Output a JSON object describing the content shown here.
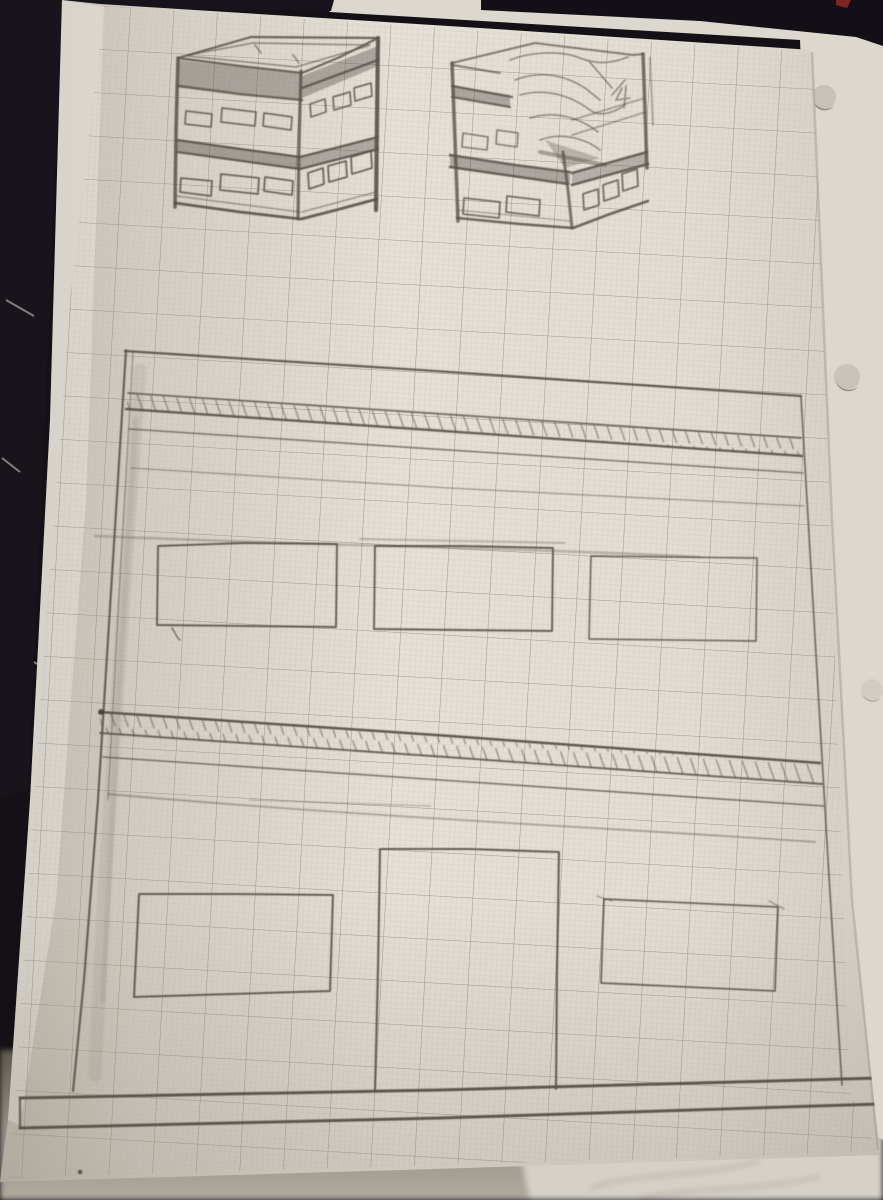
{
  "meta": {
    "title": "Photograph of pencil sketches on graph paper",
    "subject": "hand-drawn architectural pencil sketches on millimetre graph paper, photographed on a dark fabric surface"
  },
  "colors": {
    "background_fabric": "#17151b",
    "desk": "#8d877d",
    "paper_bright": "#e4e0d8",
    "paper_shadow": "#bfb9ae",
    "paper_margin": "#edebe5",
    "backing_sheet": "#dcd7cf",
    "crumpled_paper": "#d8d3cb",
    "grid_minor": "#b3ab9c",
    "grid_major": "#8f8574",
    "pencil": "#57514a",
    "pencil_dark": "#3f3a33",
    "pencil_faint": "#8a837a",
    "smudge": "#6e6860",
    "edge_shadow": "#a39c90",
    "red_mark": "#7f241e",
    "hole": "#c7c1b7",
    "hole_shadow": "#918a7e"
  },
  "paper": {
    "type": "graph paper, fine millimetre grid with bold major squares",
    "orientation": "portrait, rotated slightly clockwise",
    "punched_holes_visible": 3,
    "hole_side": "right edge of backing sheet"
  },
  "scene": {
    "regions": [
      "dark fabric background at top and left",
      "white backing sheet behind on the right with punch holes",
      "blurred desk and crumpled paper along the bottom edge"
    ]
  },
  "sketch": {
    "box_left": "two-storey open-top box in two-point perspective with rows of small windows and dark floor bands",
    "box_right": "same two-storey box, messier, top partly cut open showing scribbled interior",
    "elevation": {
      "label": "building front elevation",
      "features": [
        "long top parapet line",
        "upper hatched floor-slab band",
        "three upper-storey windows in a row",
        "lower hatched floor-slab band",
        "tall central doorway",
        "two lower-storey windows",
        "thick ground base strip",
        "vertical eraser smudge along left wall"
      ],
      "upper_window_count": 3,
      "lower_window_count": 2,
      "door_count": 1,
      "hatch_direction": "steep diagonal, top-left to bottom-right"
    }
  }
}
